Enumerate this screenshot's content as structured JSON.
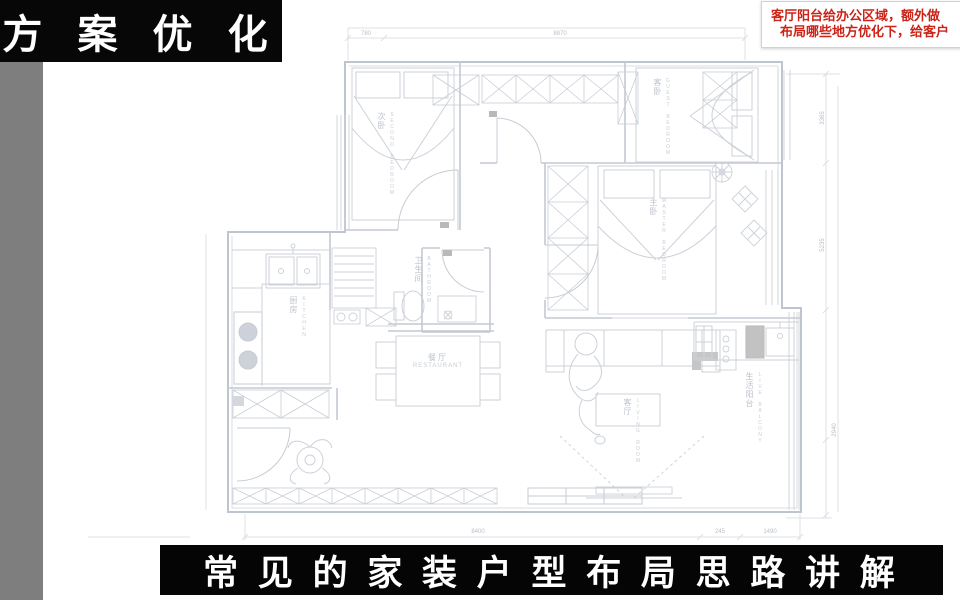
{
  "banner": {
    "title": "方 案 优 化"
  },
  "caption": {
    "text": "常 见 的 家 装 户 型 布 局 思 路 讲 解"
  },
  "note": {
    "line1": "客厅阳台给办公区域，额外做",
    "line2": "布局哪些地方优化下，给客户"
  },
  "colors": {
    "banner_bg": "#070707",
    "caption_bg": "#050505",
    "sidebar_gray": "#7e7e7e",
    "note_red": "#cb2318",
    "plan_line": "#c2c7d0"
  },
  "floorplan": {
    "rooms": {
      "second_bedroom": {
        "cn": "次卧",
        "en": "SECOND BEDROOM"
      },
      "guest_bedroom": {
        "cn": "客卧",
        "en": "GUEST BEDROOM"
      },
      "master_bedroom": {
        "cn": "主卧",
        "en": "MASTER BEDROOM"
      },
      "kitchen": {
        "cn": "厨房",
        "en": "KITCHEN"
      },
      "dining": {
        "cn": "餐厅",
        "en": "RESTAURANT"
      },
      "living": {
        "cn": "客厅",
        "en": "LIVING ROOM"
      },
      "bathroom": {
        "cn": "卫生间",
        "en": "BATHROOM"
      },
      "balcony": {
        "cn": "生活阳台",
        "en": "LIVE BALCONY"
      }
    },
    "dims": {
      "top_left": "780",
      "top_main": "8870",
      "right_upper": "3365",
      "right_middle": "5235",
      "right_lower": "2940",
      "bottom_main": "8400",
      "bottom_right_a": "245",
      "bottom_right_b": "1490"
    }
  }
}
